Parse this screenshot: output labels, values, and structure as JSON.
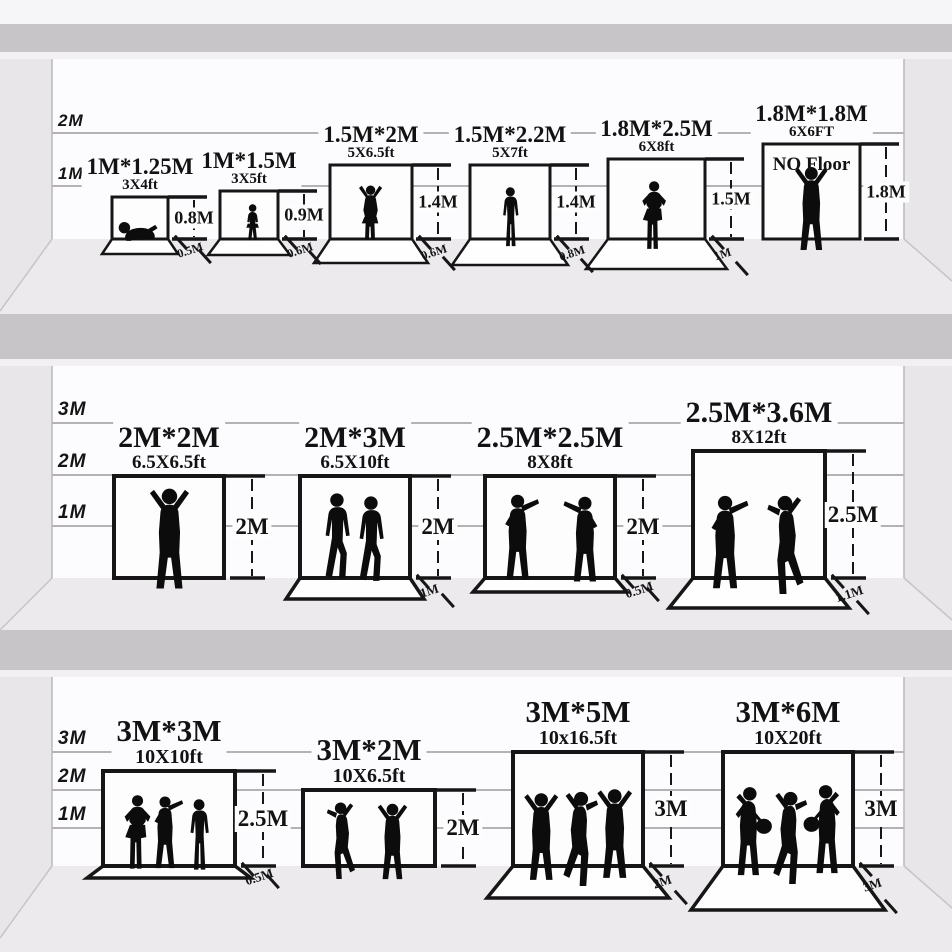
{
  "colors": {
    "ink": "#161616",
    "silhouette": "#0c0c0c",
    "wall": "#fcfbfd",
    "floor": "#eceaed",
    "divider": "#c8c5c9",
    "side_wall": "#e9e6ea",
    "grid_line": "#b5b2b6",
    "mat": "#fefefe",
    "page": "#f6f5f7"
  },
  "rows": [
    {
      "name": "row-1",
      "scale_labels": [
        "2M",
        "1M"
      ],
      "items": [
        {
          "title": "1M*1.25M",
          "subtitle": "3X4ft",
          "height_label": "0.8M",
          "floor_label": "0.5M",
          "figures": [
            "crawling-baby"
          ]
        },
        {
          "title": "1M*1.5M",
          "subtitle": "3X5ft",
          "height_label": "0.9M",
          "floor_label": "0.6M",
          "figures": [
            "toddler"
          ]
        },
        {
          "title": "1.5M*2M",
          "subtitle": "5X6.5ft",
          "height_label": "1.4M",
          "floor_label": "0.6M",
          "figures": [
            "child-arms-up"
          ]
        },
        {
          "title": "1.5M*2.2M",
          "subtitle": "5X7ft",
          "height_label": "1.4M",
          "floor_label": "0.8M",
          "figures": [
            "standing-child"
          ]
        },
        {
          "title": "1.8M*2.5M",
          "subtitle": "6X8ft",
          "height_label": "1.5M",
          "floor_label": "1M",
          "figures": [
            "man-hands-on-hips"
          ]
        },
        {
          "title": "1.8M*1.8M",
          "subtitle": "6X6FT",
          "height_label": "1.8M",
          "floor_label": null,
          "no_floor_text": "NO Floor",
          "figures": [
            "man-arms-raised"
          ]
        }
      ]
    },
    {
      "name": "row-2",
      "scale_labels": [
        "3M",
        "2M",
        "1M"
      ],
      "items": [
        {
          "title": "2M*2M",
          "subtitle": "6.5X6.5ft",
          "height_label": "2M",
          "floor_label": null,
          "figures": [
            "man-arms-raised"
          ]
        },
        {
          "title": "2M*3M",
          "subtitle": "6.5X10ft",
          "height_label": "2M",
          "floor_label": "1M",
          "figures": [
            "walking-man",
            "walking-man"
          ]
        },
        {
          "title": "2.5M*2.5M",
          "subtitle": "8X8ft",
          "height_label": "2M",
          "floor_label": "0.5M",
          "figures": [
            "gesturing-man",
            "gesturing-man-flipped"
          ]
        },
        {
          "title": "2.5M*3.6M",
          "subtitle": "8X12ft",
          "height_label": "2.5M",
          "floor_label": "1.1M",
          "figures": [
            "pointing-man",
            "man-arm-up-flipped"
          ]
        }
      ]
    },
    {
      "name": "row-3",
      "scale_labels": [
        "3M",
        "2M",
        "1M"
      ],
      "items": [
        {
          "title": "3M*3M",
          "subtitle": "10X10ft",
          "height_label": "2.5M",
          "floor_label": "0.5M",
          "figures": [
            "man-hands-on-hips",
            "pointing-man",
            "standing-man"
          ]
        },
        {
          "title": "3M*2M",
          "subtitle": "10X6.5ft",
          "height_label": "2M",
          "floor_label": null,
          "figures": [
            "dancing-man-flipped",
            "man-arms-raised"
          ]
        },
        {
          "title": "3M*5M",
          "subtitle": "10x16.5ft",
          "height_label": "3M",
          "floor_label": "2M",
          "figures": [
            "man-arms-raised",
            "dancing-man",
            "man-arms-raised-flipped"
          ]
        },
        {
          "title": "3M*6M",
          "subtitle": "10X20ft",
          "height_label": "3M",
          "floor_label": "3M",
          "figures": [
            "guitarist",
            "dancing-man",
            "guitarist-flipped"
          ]
        }
      ]
    }
  ]
}
